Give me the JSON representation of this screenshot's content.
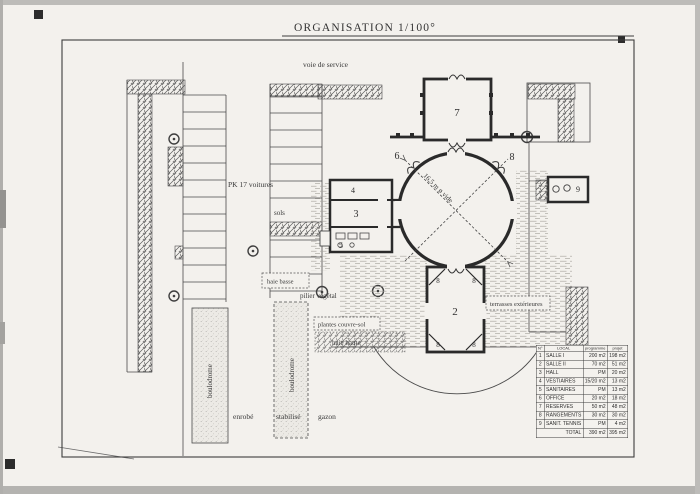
{
  "title": "ORGANISATION 1/100°",
  "colors": {
    "paper": "#f3f1ed",
    "ink": "#3a3a3a",
    "wall": "#2a2a2a"
  },
  "plan": {
    "labels": {
      "voie_de_service": "voie de service",
      "pk17": "PK 17 voitures",
      "sols": "sols",
      "haie_basse": "haie basse",
      "pilier_vegetal": "pilier végétal",
      "plantes_couvre_sol": "plantes couvre-sol",
      "haie_haute": "haie haute",
      "terrasses_exterieures": "terrasses extérieures",
      "boulodrome1": "boulodrome",
      "boulodrome2": "boulodrome",
      "enrobe": "enrobé",
      "stabilise": "stabilisé",
      "gazon": "gazon"
    },
    "dimension": "16,5 m ø vide",
    "rooms": {
      "salle2": "2",
      "hall": "3",
      "vestiaires": "4",
      "sanitaires": "5",
      "office": "6",
      "reserves": "7",
      "rangements": "8",
      "closet": "8",
      "sanit_tennis": "9"
    }
  },
  "table": {
    "headers": [
      "N°",
      "LOCAL",
      "programme",
      "projet"
    ],
    "rows": [
      [
        "1",
        "SALLE I",
        "200 m2",
        "198 m2"
      ],
      [
        "2",
        "SALLE II",
        "70 m2",
        "51 m2"
      ],
      [
        "3",
        "HALL",
        "PM",
        "20 m2"
      ],
      [
        "4",
        "VESTIAIRES",
        "15/20 m2",
        "13 m2"
      ],
      [
        "5",
        "SANITAIRES",
        "PM",
        "13 m2"
      ],
      [
        "6",
        "OFFICE",
        "20 m2",
        "18 m2"
      ],
      [
        "7",
        "RESERVES",
        "50 m2",
        "48 m2"
      ],
      [
        "8",
        "RANGEMENTS",
        "30 m2",
        "30 m2"
      ],
      [
        "9",
        "SANIT. TENNIS",
        "PM",
        "4 m2"
      ]
    ],
    "total": [
      "",
      "TOTAL",
      "390 m2",
      "395 m2"
    ]
  }
}
